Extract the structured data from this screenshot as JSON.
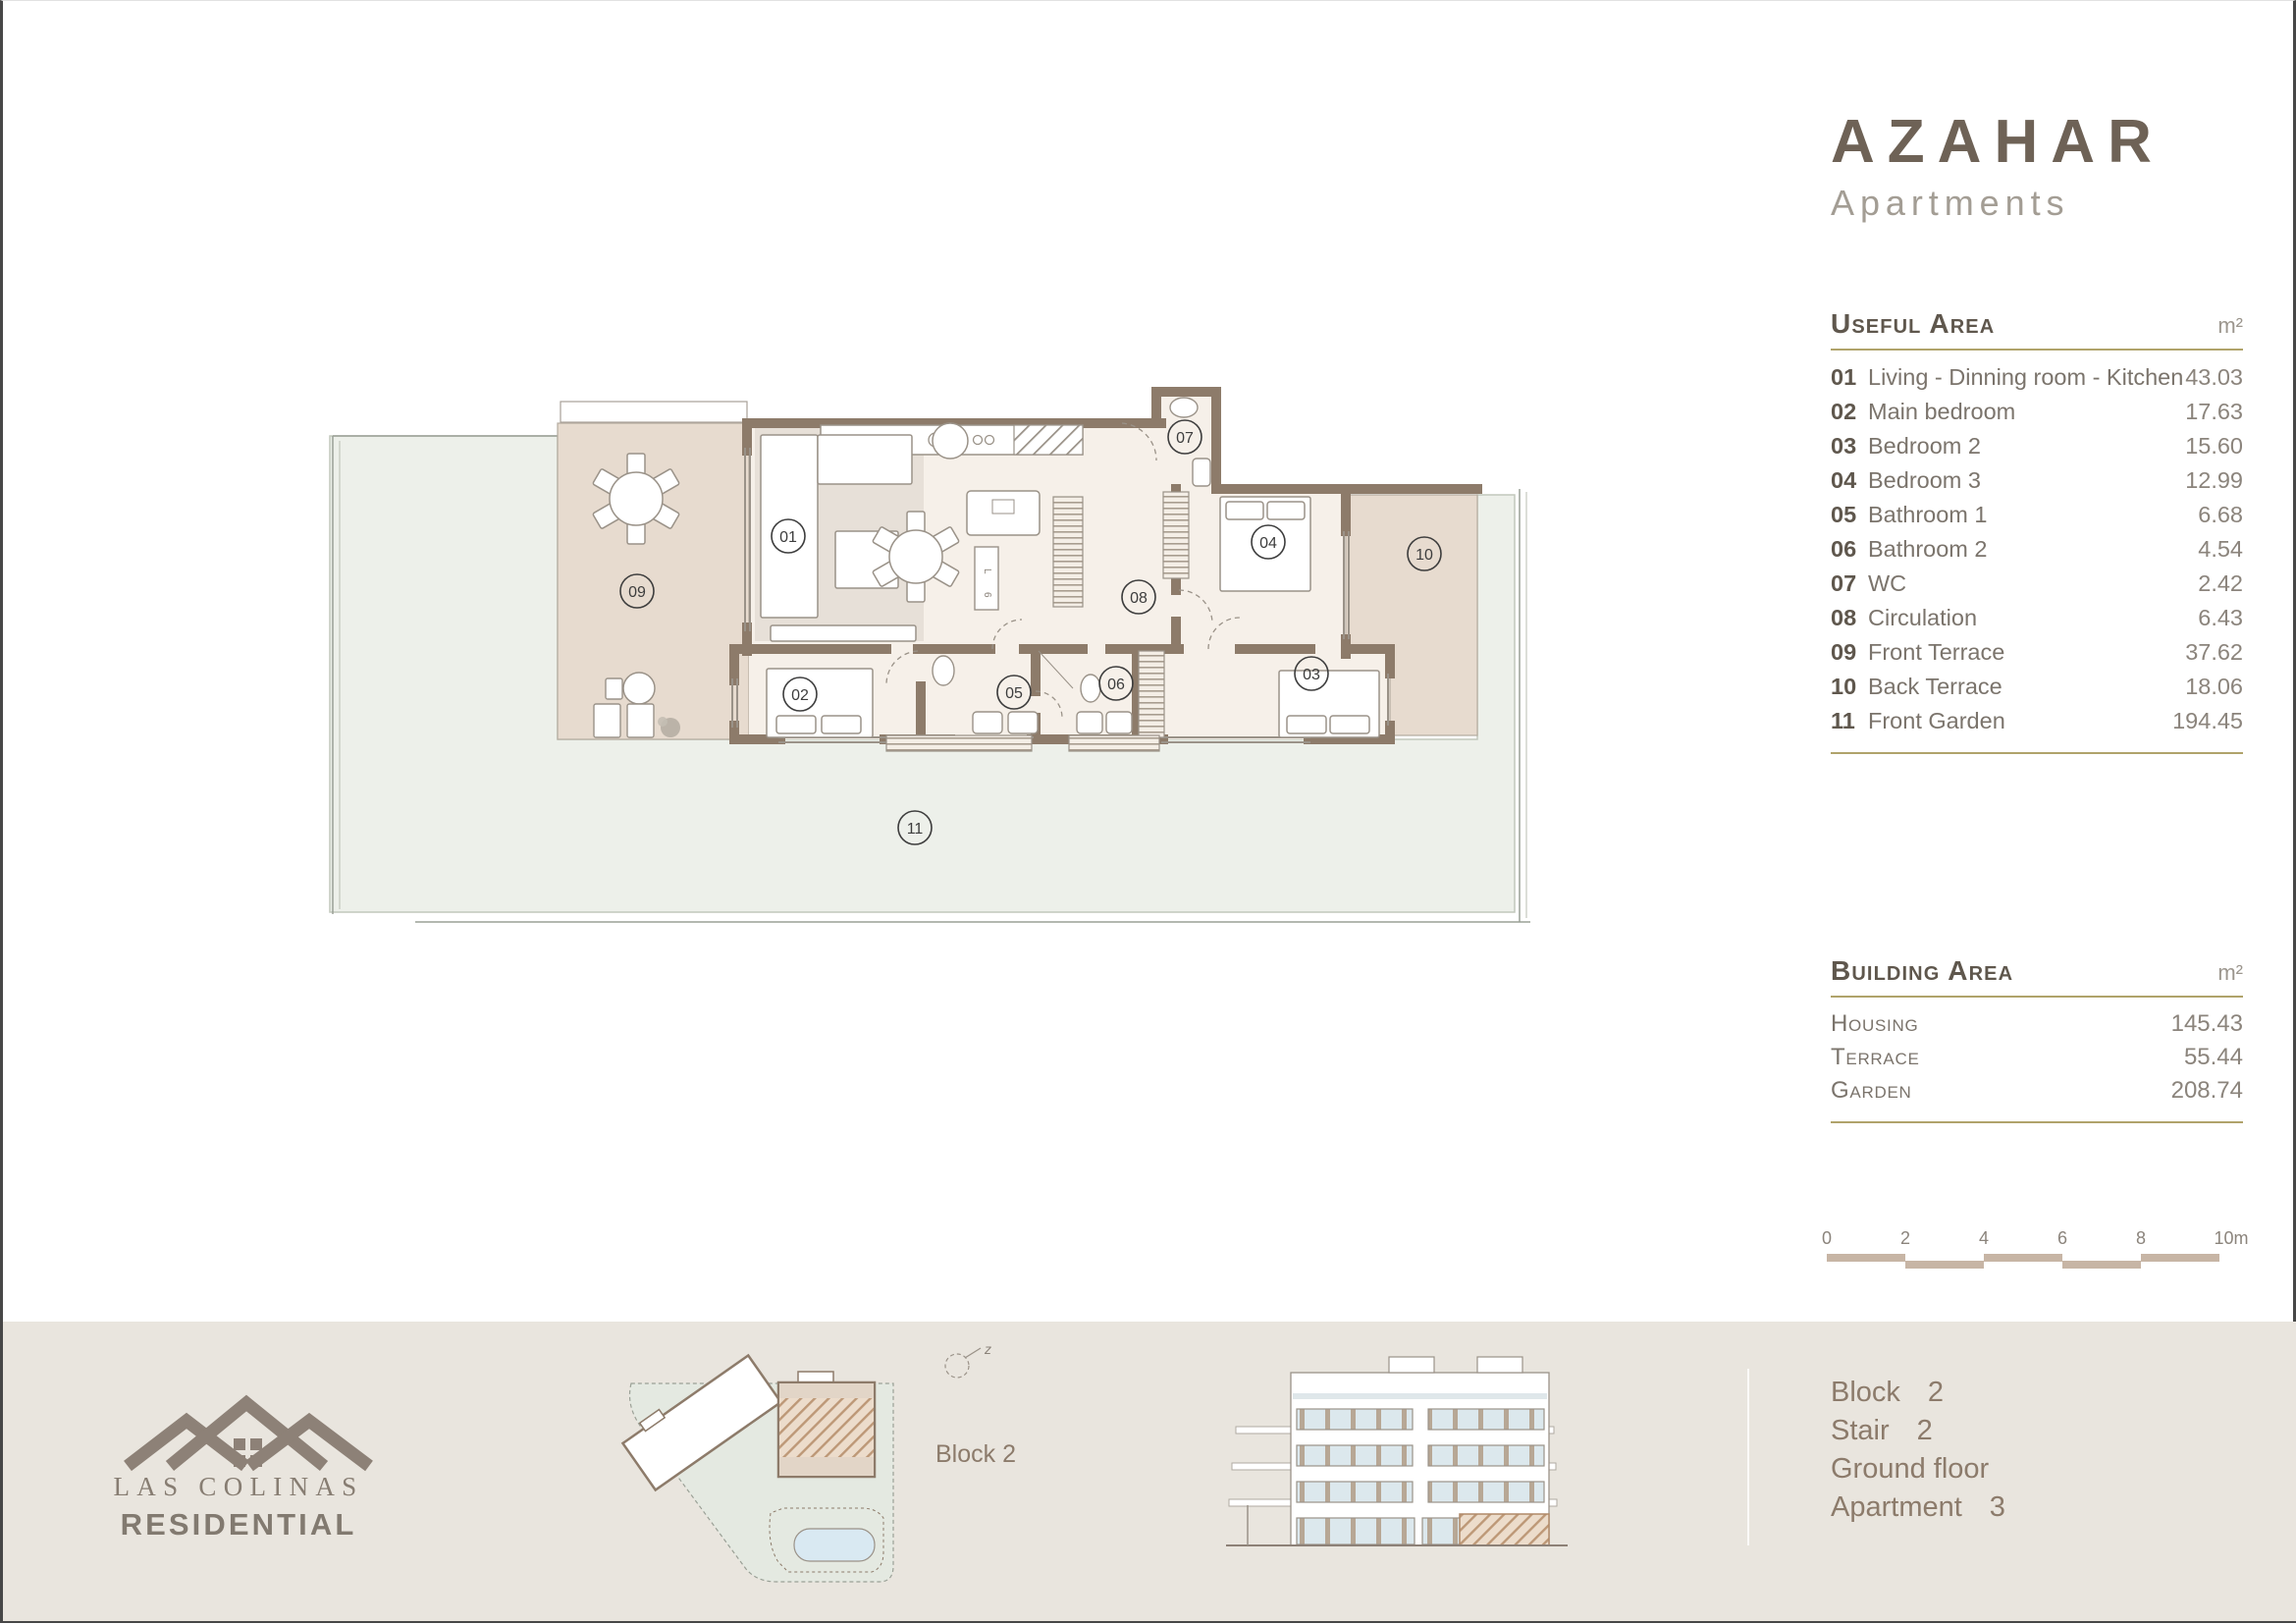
{
  "brand": {
    "title": "AZAHAR",
    "subtitle": "Apartments"
  },
  "useful_area": {
    "title": "Useful Area",
    "unit": "m²",
    "rows": [
      {
        "num": "01",
        "label": "Living - Dinning room - Kitchen",
        "value": "43.03"
      },
      {
        "num": "02",
        "label": "Main bedroom",
        "value": "17.63"
      },
      {
        "num": "03",
        "label": "Bedroom 2",
        "value": "15.60"
      },
      {
        "num": "04",
        "label": "Bedroom 3",
        "value": "12.99"
      },
      {
        "num": "05",
        "label": "Bathroom 1",
        "value": "6.68"
      },
      {
        "num": "06",
        "label": "Bathroom 2",
        "value": "4.54"
      },
      {
        "num": "07",
        "label": "WC",
        "value": "2.42"
      },
      {
        "num": "08",
        "label": "Circulation",
        "value": "6.43"
      },
      {
        "num": "09",
        "label": "Front Terrace",
        "value": "37.62"
      },
      {
        "num": "10",
        "label": "Back Terrace",
        "value": "18.06"
      },
      {
        "num": "11",
        "label": "Front Garden",
        "value": "194.45"
      }
    ]
  },
  "building_area": {
    "title": "Building Area",
    "unit": "m²",
    "rows": [
      {
        "label": "Housing",
        "value": "145.43"
      },
      {
        "label": "Terrace",
        "value": "55.44"
      },
      {
        "label": "Garden",
        "value": "208.74"
      }
    ]
  },
  "scale_bar": {
    "ticks": [
      "0",
      "2",
      "4",
      "6",
      "8",
      "10m"
    ]
  },
  "floor_plan": {
    "rooms": [
      {
        "num": "01"
      },
      {
        "num": "02"
      },
      {
        "num": "03"
      },
      {
        "num": "04"
      },
      {
        "num": "05"
      },
      {
        "num": "06"
      },
      {
        "num": "07"
      },
      {
        "num": "08"
      },
      {
        "num": "09"
      },
      {
        "num": "10"
      },
      {
        "num": "11"
      }
    ],
    "laundry": [
      "L",
      "6"
    ]
  },
  "site_plan": {
    "label": "Block 2",
    "north_label": "z"
  },
  "footer": {
    "logo_line1": "LAS COLINAS",
    "logo_line2": "RESIDENTIAL",
    "info": [
      {
        "label": "Block",
        "value": "2"
      },
      {
        "label": "Stair",
        "value": "2"
      },
      {
        "label": "Ground floor",
        "value": ""
      },
      {
        "label": "Apartment",
        "value": "3"
      }
    ]
  },
  "colors": {
    "gold": "#b0a36b",
    "wall": "#8d7b6a",
    "terrace": "#e7dbcf",
    "garden": "#edf0ea",
    "interior": "#f6f0e9",
    "footer_bg": "#e9e5de"
  }
}
